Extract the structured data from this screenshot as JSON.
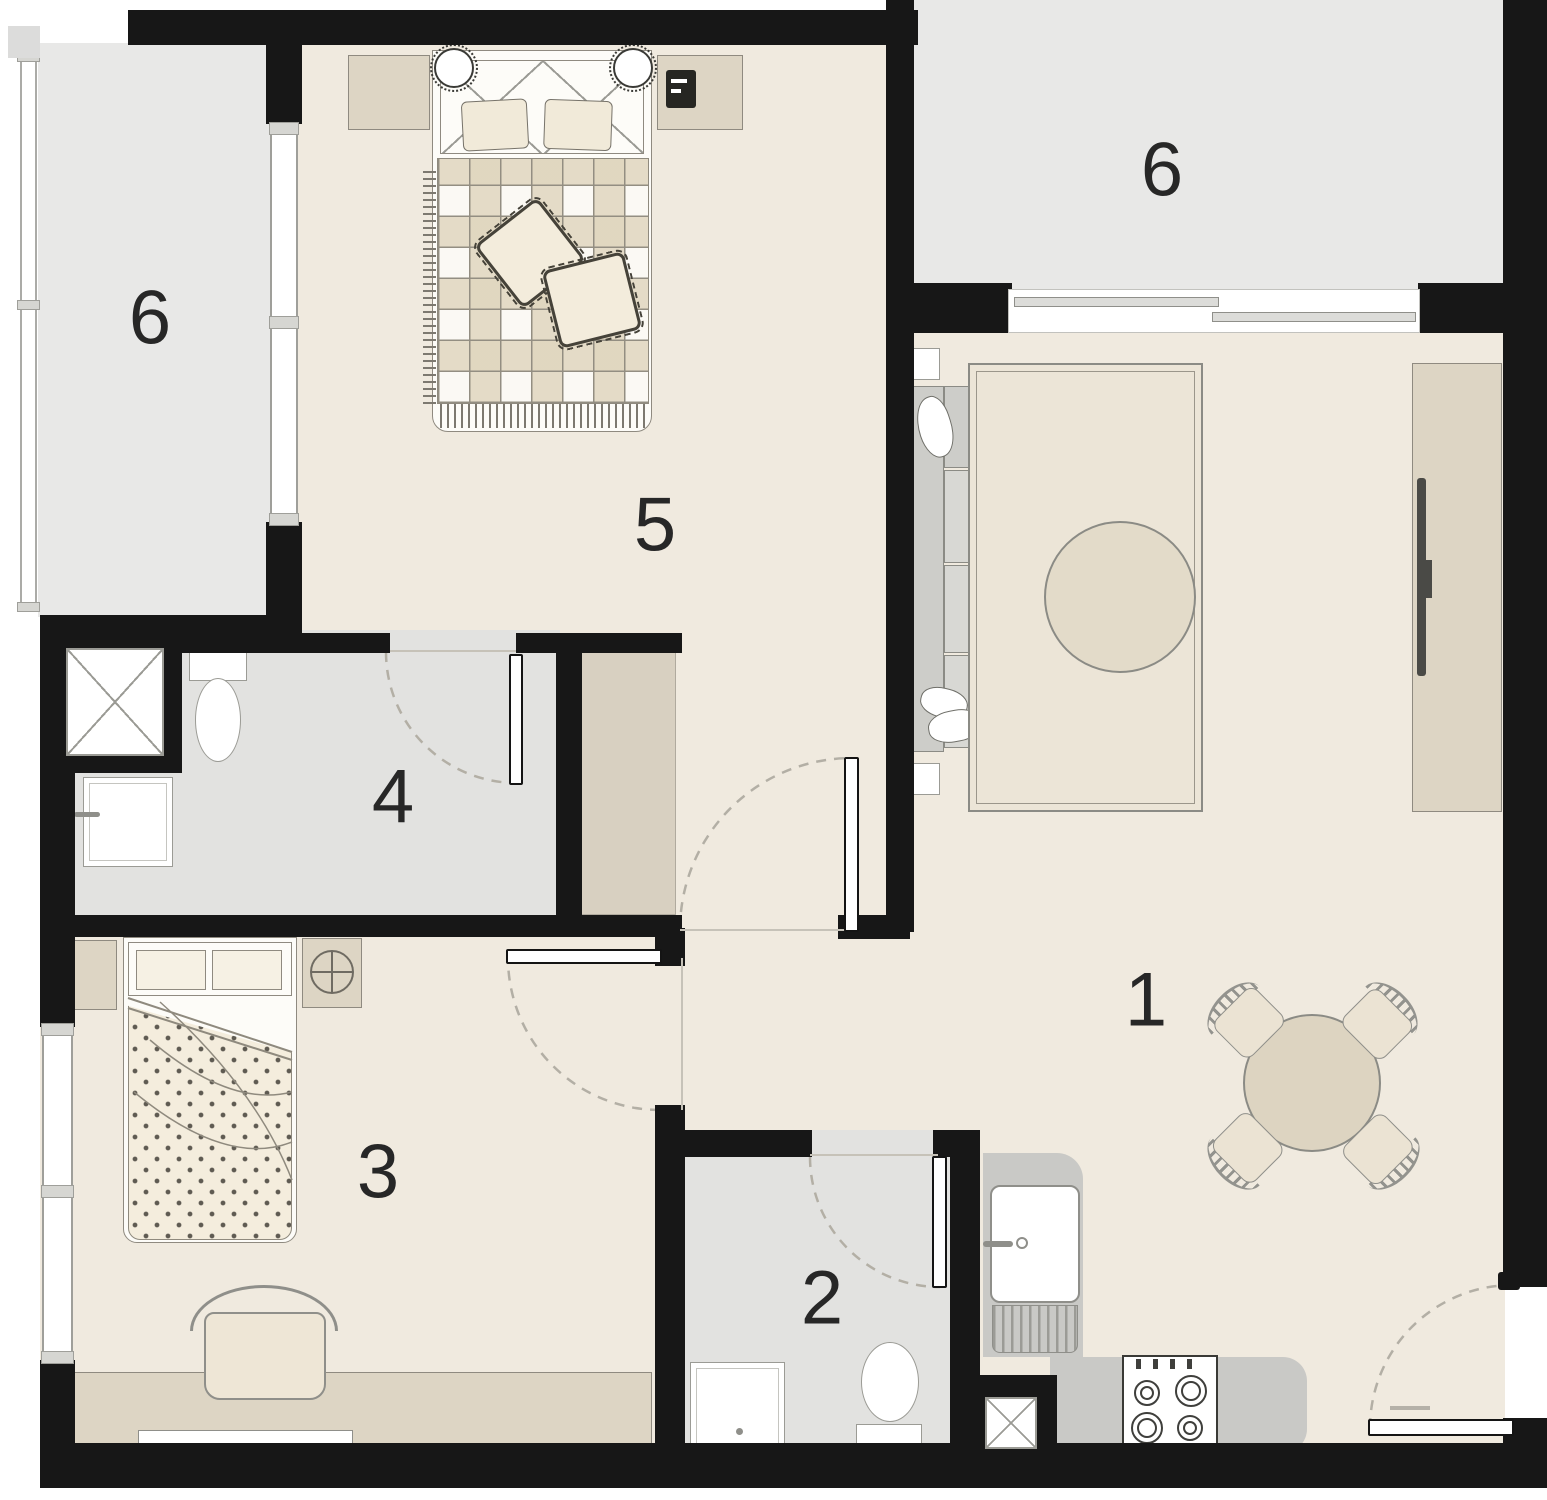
{
  "plan": {
    "rooms": [
      {
        "id": "living-dining-kitchen",
        "label": "1"
      },
      {
        "id": "bathroom-social",
        "label": "2"
      },
      {
        "id": "bedroom-2",
        "label": "3"
      },
      {
        "id": "bathroom-suite",
        "label": "4"
      },
      {
        "id": "bedroom-suite",
        "label": "5"
      },
      {
        "id": "balcony-left",
        "label": "6"
      },
      {
        "id": "balcony-right",
        "label": "6"
      }
    ],
    "colors": {
      "wall": "#171717",
      "floor": "#f0eadf",
      "wet_floor": "#e2e2e0",
      "balcony": "#e8e8e7",
      "furniture_beige": "#ddd5c4",
      "counter_gray": "#c9c9c6",
      "sofa_gray": "#cdcdc9",
      "door_arc": "#b3afa5"
    }
  }
}
